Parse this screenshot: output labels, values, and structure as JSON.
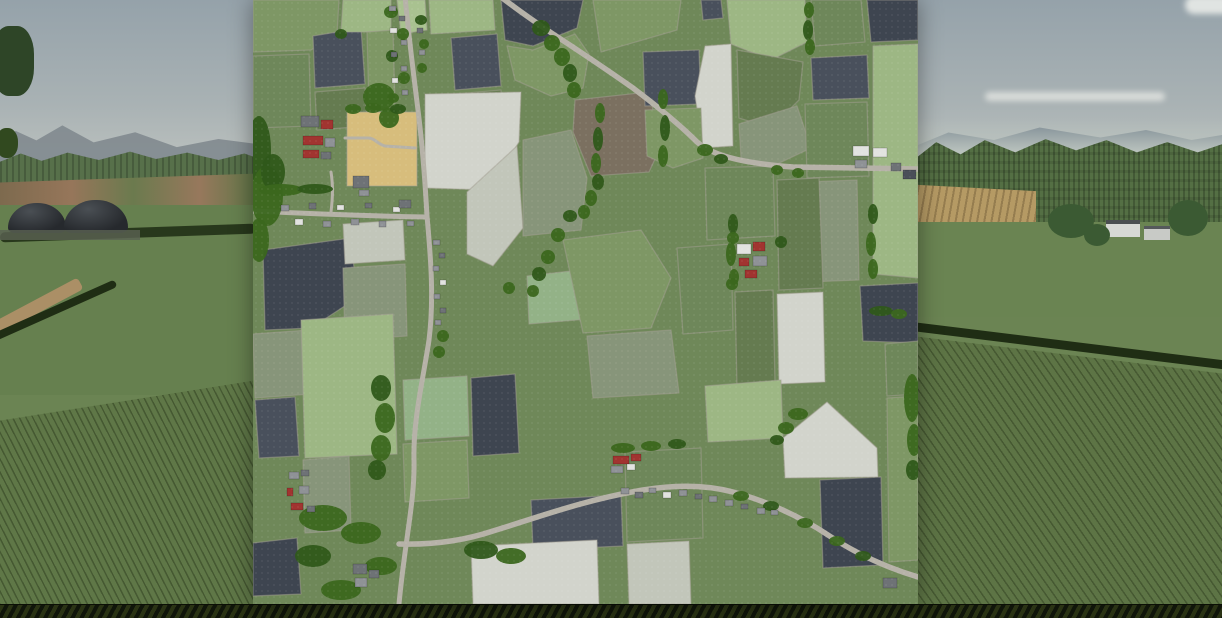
{
  "scene": {
    "description": "Farming-simulator style screenshot: 3D countryside landscape background with a square top-down farm map overlay centered on screen",
    "background": "rolling fields, distant hills, forests, biogas plant domes on left, farmstead on right, crop rows in foreground",
    "overlay": "overhead farmland map with polygonal fields, roads, villages, farms and tree lines"
  },
  "palette": {
    "sky_top": "#95a2aa",
    "sky_horizon": "#cdd0c9",
    "hills": "#81898f",
    "forest": "#546f44",
    "grass": "#66804f",
    "crop_rows": "#5f7747",
    "hedge": "#1f2d14",
    "dome": "#26292d",
    "red_soil_band": "#96765a",
    "cloud": "#e9eae6",
    "bottom_strip": "#141a0a",
    "map": {
      "base": "#6f8859",
      "boundary": "#a49f93",
      "road": "#b6b2a8",
      "tree1": "#3b671e",
      "tree2": "#2f591a",
      "fields": {
        "g2": "#7e9765",
        "g3": "#6e875a",
        "g4": "#657b50",
        "lg": "#9db784",
        "lg2": "#a9c290",
        "mint": "#93b287",
        "sg": "#87957a",
        "wh": "#d2d4cc",
        "wh2": "#c2c6ba",
        "dk": "#49505c",
        "dk2": "#3e4550",
        "br": "#7b7060",
        "tan": "#d7bd7c"
      },
      "buildings": {
        "red": "#a13430",
        "gray": "#8f9296",
        "gray2": "#6e7276",
        "white": "#e2e3e0",
        "dark": "#4a4f58"
      }
    }
  },
  "map": {
    "left": 253,
    "top": 0,
    "width": 665,
    "height": 604,
    "fields": [
      {
        "c": "g2",
        "pts": "0,0 86,0 84,34 58,50 0,52"
      },
      {
        "c": "g3",
        "pts": "0,56 56,54 58,126 0,128"
      },
      {
        "c": "dk",
        "pts": "60,36 108,28 112,84 62,88"
      },
      {
        "c": "g4",
        "pts": "62,92 112,88 114,126 64,130"
      },
      {
        "c": "lg",
        "pts": "90,0 138,0 138,32 88,32"
      },
      {
        "c": "g2",
        "pts": "114,32 140,30 142,106 116,108"
      },
      {
        "c": "lg2",
        "pts": "144,0 172,0 174,30 148,34"
      },
      {
        "c": "lg",
        "pts": "176,0 240,0 242,30 178,34"
      },
      {
        "c": "dk",
        "pts": "198,38 244,34 248,86 202,90"
      },
      {
        "c": "g4",
        "pts": "202,94 248,90 250,122 204,126"
      },
      {
        "c": "dk2",
        "pts": "248,0 330,0 324,28 280,46 252,40"
      },
      {
        "c": "g2",
        "pts": "254,46 280,50 322,34 336,54 330,88 298,96 262,80"
      },
      {
        "c": "br",
        "pts": "322,100 396,92 408,146 396,172 338,176 320,132"
      },
      {
        "c": "wh",
        "pts": "172,94 268,92 266,142 236,190 172,188"
      },
      {
        "c": "wh2",
        "pts": "214,192 264,146 270,228 240,266 214,254"
      },
      {
        "c": "tan",
        "pts": "94,112 164,112 164,186 94,186"
      },
      {
        "c": "g2",
        "pts": "340,0 428,0 424,30 348,52"
      },
      {
        "c": "dk",
        "pts": "448,0 468,0 470,18 450,20"
      },
      {
        "c": "lg",
        "pts": "474,0 552,0 554,42 518,60 478,44"
      },
      {
        "c": "g3",
        "pts": "558,0 608,0 612,42 562,46"
      },
      {
        "c": "dk2",
        "pts": "614,0 665,0 665,40 618,42"
      },
      {
        "c": "dk",
        "pts": "390,52 446,50 448,104 392,106"
      },
      {
        "c": "dk",
        "pts": "558,58 614,55 616,98 560,100"
      },
      {
        "c": "wh",
        "pts": "452,46 478,44 480,146 450,148 442,96"
      },
      {
        "c": "g4",
        "pts": "484,50 550,62 546,100 518,128 486,118"
      },
      {
        "c": "g2",
        "pts": "392,110 448,108 450,158 420,168 394,156"
      },
      {
        "c": "sg",
        "pts": "486,124 544,106 558,148 520,166 488,158"
      },
      {
        "c": "lg",
        "pts": "620,46 665,44 665,278 620,274"
      },
      {
        "c": "g3",
        "pts": "552,104 614,102 616,176 554,178"
      },
      {
        "c": "sg",
        "pts": "552,182 604,180 606,280 554,282"
      },
      {
        "c": "sg",
        "pts": "270,140 318,130 334,178 328,230 270,236"
      },
      {
        "c": "mint",
        "pts": "274,276 344,268 348,318 276,324"
      },
      {
        "c": "g4",
        "pts": "524,180 566,178 570,288 526,290"
      },
      {
        "c": "wh",
        "pts": "524,294 570,292 572,382 526,384"
      },
      {
        "c": "dk2",
        "pts": "607,286 665,283 665,343 610,341"
      },
      {
        "c": "g3",
        "pts": "452,168 520,166 522,236 454,240"
      },
      {
        "c": "dk2",
        "pts": "10,250 98,238 104,298 58,328 12,330"
      },
      {
        "c": "wh2",
        "pts": "90,224 150,220 152,260 92,264"
      },
      {
        "c": "sg",
        "pts": "90,268 152,264 154,336 92,340"
      },
      {
        "c": "g2",
        "pts": "310,240 388,230 418,278 398,328 330,333"
      },
      {
        "c": "sg",
        "pts": "334,336 418,330 426,393 340,398"
      },
      {
        "c": "g3",
        "pts": "424,248 478,244 480,330 430,334"
      },
      {
        "c": "g4",
        "pts": "482,292 520,290 522,384 484,388"
      },
      {
        "c": "sg",
        "pts": "0,334 56,330 58,394 2,398"
      },
      {
        "c": "dk",
        "pts": "2,400 42,397 46,456 6,458"
      },
      {
        "c": "lg",
        "pts": "48,320 140,314 144,454 52,458"
      },
      {
        "c": "mint",
        "pts": "150,380 214,376 216,436 152,440"
      },
      {
        "c": "dk2",
        "pts": "218,378 262,374 266,453 220,456"
      },
      {
        "c": "g2",
        "pts": "150,444 214,440 216,498 152,502"
      },
      {
        "c": "sg",
        "pts": "50,460 96,456 98,530 52,533"
      },
      {
        "c": "dk2",
        "pts": "0,543 44,538 48,594 0,596"
      },
      {
        "c": "dk",
        "pts": "278,500 368,495 370,546 280,550"
      },
      {
        "c": "wh",
        "pts": "218,546 344,540 346,604 220,604"
      },
      {
        "c": "wh2",
        "pts": "374,544 436,541 438,604 376,604"
      },
      {
        "c": "lg",
        "pts": "452,386 528,380 530,438 455,442"
      },
      {
        "c": "wh",
        "pts": "530,438 574,402 624,448 625,477 532,478"
      },
      {
        "c": "dk2",
        "pts": "567,480 628,477 630,565 570,568"
      },
      {
        "c": "g3",
        "pts": "632,344 665,341 665,394 634,396"
      },
      {
        "c": "g2",
        "pts": "634,398 665,396 665,560 636,562"
      },
      {
        "c": "g3",
        "pts": "372,452 448,448 450,538 374,542"
      }
    ],
    "roads": [
      {
        "d": "M244,-6 Q270,14 300,34 Q340,60 380,88 Q420,118 444,142 C462,158 500,164 540,167 L665,169",
        "w": 5.5
      },
      {
        "d": "M152,-4 C155,30 160,70 165,110 C170,150 172,180 174,216 C178,260 181,300 176,340 C170,380 160,420 161,460 C162,500 152,540 146,604",
        "w": 5
      },
      {
        "d": "M0,211 C60,214 120,216 174,217",
        "w": 5
      },
      {
        "d": "M146,544 C180,545 210,541 240,531 C280,519 330,500 390,490 C420,485 450,484 480,492 C510,500 545,515 575,535 C605,555 635,568 665,577",
        "w": 5.5
      },
      {
        "d": "M92,138 L115,138 C122,138 124,144 132,146 L162,148",
        "w": 3
      },
      {
        "d": "M78,212 C80,195 80,185 78,172",
        "w": 3
      }
    ],
    "trees": [
      [
        6,
        150,
        12,
        34
      ],
      [
        14,
        196,
        16,
        30
      ],
      [
        6,
        240,
        10,
        22
      ],
      [
        20,
        172,
        12,
        18
      ],
      [
        126,
        97,
        16,
        14
      ],
      [
        136,
        118,
        10,
        10
      ],
      [
        88,
        34,
        6,
        5
      ],
      [
        138,
        12,
        7,
        6
      ],
      [
        150,
        34,
        6,
        6
      ],
      [
        139,
        56,
        6,
        6
      ],
      [
        151,
        78,
        6,
        6
      ],
      [
        140,
        98,
        6,
        5
      ],
      [
        168,
        20,
        6,
        5
      ],
      [
        171,
        44,
        5,
        5
      ],
      [
        169,
        68,
        5,
        5
      ],
      [
        288,
        28,
        9,
        8
      ],
      [
        299,
        43,
        8,
        8
      ],
      [
        309,
        57,
        8,
        9
      ],
      [
        317,
        73,
        7,
        9
      ],
      [
        321,
        90,
        7,
        8
      ],
      [
        347,
        113,
        5,
        10
      ],
      [
        345,
        139,
        5,
        12
      ],
      [
        343,
        163,
        5,
        10
      ],
      [
        410,
        99,
        5,
        10
      ],
      [
        412,
        128,
        5,
        13
      ],
      [
        410,
        156,
        5,
        11
      ],
      [
        556,
        10,
        5,
        8
      ],
      [
        555,
        30,
        5,
        10
      ],
      [
        557,
        47,
        5,
        8
      ],
      [
        452,
        150,
        8,
        6
      ],
      [
        468,
        159,
        7,
        5
      ],
      [
        524,
        170,
        6,
        5
      ],
      [
        545,
        173,
        6,
        5
      ],
      [
        345,
        182,
        6,
        8
      ],
      [
        338,
        198,
        6,
        8
      ],
      [
        331,
        212,
        6,
        7
      ],
      [
        317,
        216,
        7,
        6
      ],
      [
        305,
        235,
        7,
        7
      ],
      [
        295,
        257,
        7,
        7
      ],
      [
        286,
        274,
        7,
        7
      ],
      [
        280,
        291,
        6,
        6
      ],
      [
        256,
        288,
        6,
        6
      ],
      [
        620,
        214,
        5,
        10
      ],
      [
        618,
        244,
        5,
        12
      ],
      [
        620,
        269,
        5,
        10
      ],
      [
        480,
        224,
        5,
        10
      ],
      [
        478,
        254,
        5,
        12
      ],
      [
        481,
        277,
        5,
        8
      ],
      [
        628,
        311,
        12,
        5
      ],
      [
        646,
        314,
        8,
        5
      ],
      [
        480,
        238,
        6,
        6
      ],
      [
        528,
        242,
        6,
        6
      ],
      [
        479,
        284,
        6,
        6
      ],
      [
        28,
        190,
        22,
        6
      ],
      [
        62,
        189,
        18,
        5
      ],
      [
        100,
        109,
        8,
        5
      ],
      [
        120,
        108,
        8,
        5
      ],
      [
        145,
        109,
        8,
        5
      ],
      [
        190,
        336,
        6,
        6
      ],
      [
        186,
        352,
        6,
        6
      ],
      [
        128,
        388,
        10,
        13
      ],
      [
        132,
        418,
        10,
        15
      ],
      [
        128,
        448,
        10,
        13
      ],
      [
        124,
        470,
        9,
        10
      ],
      [
        70,
        518,
        24,
        13
      ],
      [
        108,
        533,
        20,
        11
      ],
      [
        60,
        556,
        18,
        11
      ],
      [
        128,
        566,
        16,
        9
      ],
      [
        88,
        590,
        20,
        10
      ],
      [
        228,
        550,
        17,
        9
      ],
      [
        258,
        556,
        15,
        8
      ],
      [
        488,
        496,
        8,
        5
      ],
      [
        518,
        506,
        8,
        5
      ],
      [
        552,
        523,
        8,
        5
      ],
      [
        584,
        541,
        8,
        5
      ],
      [
        610,
        556,
        8,
        5
      ],
      [
        545,
        414,
        10,
        6
      ],
      [
        533,
        428,
        8,
        6
      ],
      [
        524,
        440,
        7,
        5
      ],
      [
        659,
        398,
        8,
        24
      ],
      [
        661,
        440,
        7,
        16
      ],
      [
        660,
        470,
        7,
        10
      ],
      [
        370,
        448,
        12,
        5
      ],
      [
        398,
        446,
        10,
        5
      ],
      [
        424,
        444,
        9,
        5
      ]
    ],
    "buildings": [
      [
        48,
        116,
        18,
        11,
        "gray2"
      ],
      [
        68,
        120,
        12,
        9,
        "red"
      ],
      [
        50,
        136,
        20,
        9,
        "red"
      ],
      [
        72,
        138,
        10,
        9,
        "gray"
      ],
      [
        50,
        150,
        16,
        8,
        "red"
      ],
      [
        68,
        152,
        10,
        7,
        "gray2"
      ],
      [
        100,
        176,
        16,
        12,
        "gray2"
      ],
      [
        106,
        190,
        10,
        6,
        "gray"
      ],
      [
        28,
        205,
        8,
        6,
        "gray"
      ],
      [
        42,
        219,
        8,
        6,
        "white"
      ],
      [
        56,
        203,
        7,
        6,
        "gray2"
      ],
      [
        70,
        221,
        8,
        6,
        "gray"
      ],
      [
        84,
        205,
        7,
        5,
        "white"
      ],
      [
        98,
        219,
        8,
        6,
        "gray"
      ],
      [
        112,
        203,
        7,
        5,
        "gray2"
      ],
      [
        126,
        221,
        7,
        6,
        "gray"
      ],
      [
        140,
        207,
        7,
        5,
        "white"
      ],
      [
        154,
        221,
        7,
        5,
        "gray"
      ],
      [
        146,
        200,
        12,
        8,
        "gray2"
      ],
      [
        136,
        6,
        7,
        5,
        "gray"
      ],
      [
        146,
        16,
        6,
        5,
        "gray2"
      ],
      [
        137,
        28,
        7,
        5,
        "white"
      ],
      [
        148,
        40,
        6,
        5,
        "gray"
      ],
      [
        138,
        52,
        6,
        5,
        "gray2"
      ],
      [
        148,
        66,
        6,
        5,
        "gray"
      ],
      [
        139,
        78,
        6,
        5,
        "white"
      ],
      [
        149,
        90,
        6,
        5,
        "gray"
      ],
      [
        164,
        28,
        6,
        5,
        "gray2"
      ],
      [
        166,
        50,
        6,
        5,
        "gray"
      ],
      [
        180,
        240,
        7,
        5,
        "gray"
      ],
      [
        186,
        253,
        6,
        5,
        "gray2"
      ],
      [
        180,
        266,
        6,
        5,
        "gray"
      ],
      [
        187,
        280,
        6,
        5,
        "white"
      ],
      [
        181,
        294,
        6,
        5,
        "gray"
      ],
      [
        187,
        308,
        6,
        5,
        "gray2"
      ],
      [
        182,
        320,
        6,
        5,
        "gray"
      ],
      [
        600,
        146,
        16,
        10,
        "white"
      ],
      [
        620,
        148,
        14,
        9,
        "white"
      ],
      [
        602,
        160,
        12,
        8,
        "gray"
      ],
      [
        638,
        163,
        10,
        8,
        "gray2"
      ],
      [
        650,
        170,
        13,
        9,
        "dark"
      ],
      [
        484,
        244,
        14,
        10,
        "white"
      ],
      [
        500,
        242,
        12,
        9,
        "red"
      ],
      [
        486,
        258,
        10,
        8,
        "red"
      ],
      [
        500,
        256,
        14,
        10,
        "gray"
      ],
      [
        492,
        270,
        12,
        8,
        "red"
      ],
      [
        36,
        472,
        10,
        7,
        "gray"
      ],
      [
        48,
        470,
        8,
        6,
        "gray2"
      ],
      [
        34,
        488,
        6,
        8,
        "red"
      ],
      [
        46,
        486,
        10,
        8,
        "gray"
      ],
      [
        38,
        503,
        12,
        7,
        "red"
      ],
      [
        54,
        506,
        8,
        6,
        "gray2"
      ],
      [
        100,
        564,
        14,
        10,
        "gray2"
      ],
      [
        102,
        578,
        12,
        9,
        "gray"
      ],
      [
        116,
        570,
        10,
        8,
        "gray2"
      ],
      [
        360,
        456,
        16,
        8,
        "red"
      ],
      [
        378,
        454,
        10,
        7,
        "red"
      ],
      [
        358,
        466,
        12,
        7,
        "gray"
      ],
      [
        374,
        464,
        8,
        6,
        "white"
      ],
      [
        368,
        488,
        8,
        6,
        "gray"
      ],
      [
        382,
        492,
        8,
        6,
        "gray2"
      ],
      [
        396,
        488,
        7,
        5,
        "gray"
      ],
      [
        410,
        492,
        8,
        6,
        "white"
      ],
      [
        426,
        490,
        8,
        6,
        "gray"
      ],
      [
        442,
        494,
        7,
        5,
        "gray2"
      ],
      [
        456,
        496,
        8,
        6,
        "gray"
      ],
      [
        472,
        500,
        8,
        6,
        "gray"
      ],
      [
        488,
        504,
        7,
        5,
        "gray2"
      ],
      [
        504,
        508,
        8,
        6,
        "gray"
      ],
      [
        518,
        510,
        7,
        5,
        "gray"
      ],
      [
        630,
        578,
        14,
        10,
        "gray2"
      ]
    ]
  }
}
